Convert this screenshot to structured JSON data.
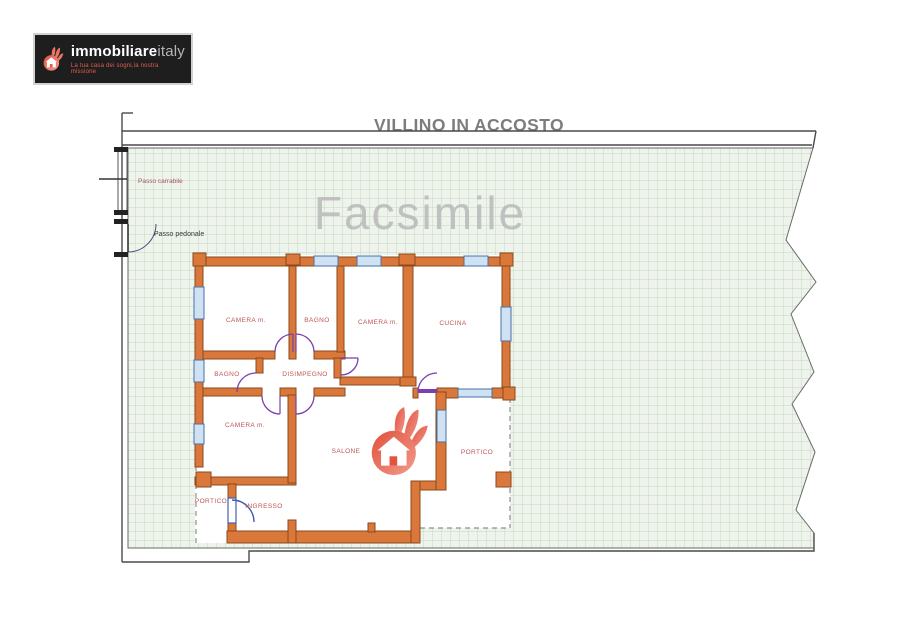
{
  "logo": {
    "brand_bold": "immobiliare",
    "brand_light": "italy",
    "tagline": "La tua casa dei sogni,la nostra missione"
  },
  "title": {
    "line1": "VILLINO IN ACCOSTO",
    "line2": "PLANIMETRIA  PIANO TERRA"
  },
  "plan": {
    "watermark": "Facsimile",
    "gates": {
      "driveway": "Passo carrabile",
      "pedestrian": "Passo pedonale"
    },
    "rooms": {
      "camera1": "CAMERA m.",
      "bagno1": "BAGNO",
      "camera2": "CAMERA m.",
      "cucina": "CUCINA",
      "bagno2": "BAGNO",
      "disimpegno": "DISIMPEGNO",
      "camera3": "CAMERA m.",
      "salone": "SALONE",
      "portico_right": "PORTICO",
      "portico_left": "PORTICO",
      "ingresso": "INGRESSO"
    },
    "colors": {
      "wall": "#d9783a",
      "wall_outline": "#8a4a1c",
      "room_label": "#bf5454",
      "grid_bg": "#eef3ec",
      "grid_line": "#c2d8c2",
      "door_arc": "#7b3fae",
      "entry_arc": "#3f5fae",
      "window_fill": "#cfe2f4",
      "window_stroke": "#4a6fa5",
      "boundary": "#4a4a4a",
      "watermark": "#b9b9b9",
      "accent": "#e4533f"
    }
  }
}
